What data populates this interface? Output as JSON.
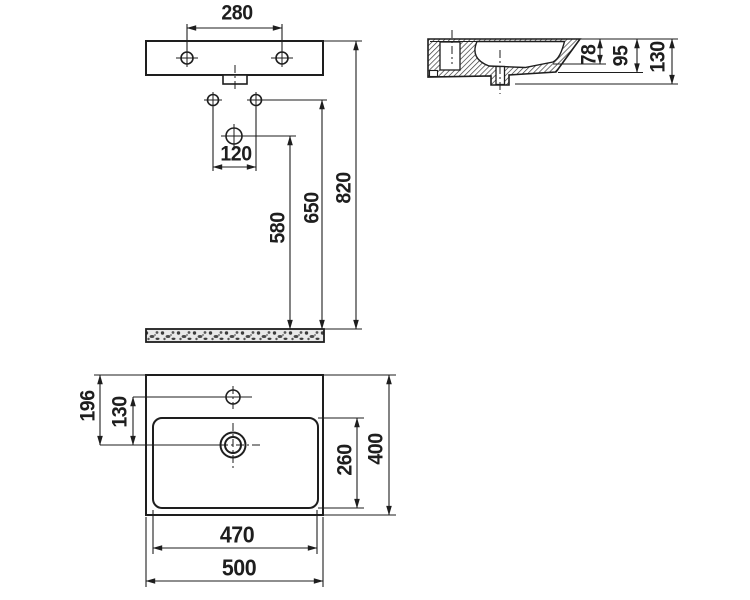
{
  "drawing_title": "washbasin dimension drawing",
  "front_view": {
    "mount_hole_spacing": "280",
    "tap_hole_spacing": "120",
    "drain_height": "580",
    "tap_hole_height": "650",
    "rim_height": "820"
  },
  "side_view": {
    "basin_depth": "78",
    "front_apron_height": "95",
    "overall_height": "130"
  },
  "plan_view": {
    "back_edge_to_drain": "196",
    "tap_hole_to_drain": "130",
    "basin_length": "470",
    "overall_length": "500",
    "basin_width": "260",
    "overall_width": "400"
  },
  "colors": {
    "line": "#1e1e1e",
    "background": "#ffffff"
  }
}
